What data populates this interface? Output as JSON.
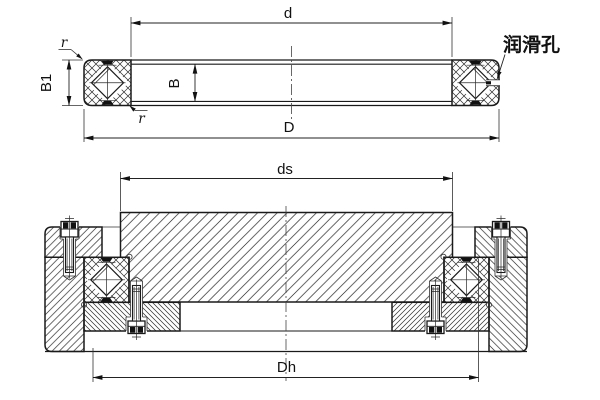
{
  "drawing": {
    "line_color": "#1a1a1a",
    "background": "#ffffff",
    "top_view": {
      "dim_bore_label": "d",
      "dim_outside_label": "D",
      "dim_width_inner_label": "B",
      "dim_width_outer_label": "B1",
      "chamfer_label_top": "r",
      "chamfer_label_bottom": "r",
      "lubrication_hole_label": "润滑孔"
    },
    "mounting_view": {
      "dim_seat_label": "ds",
      "dim_housing_label": "Dh"
    }
  }
}
